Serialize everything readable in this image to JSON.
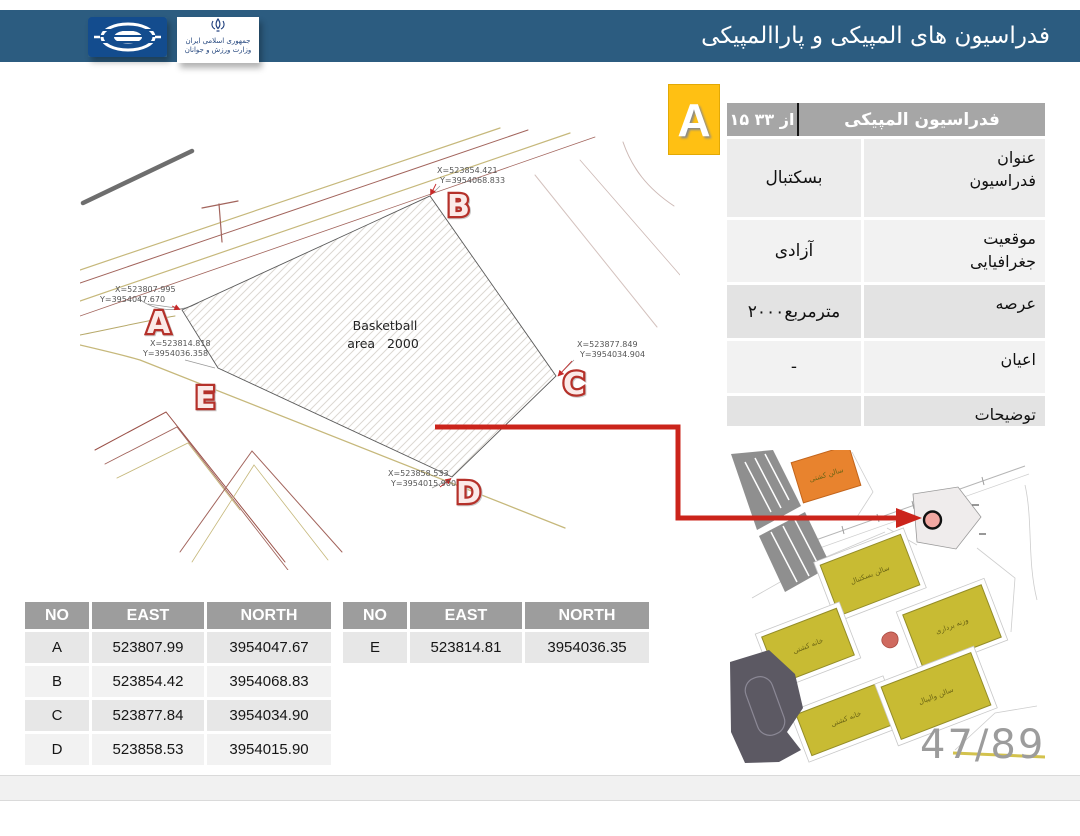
{
  "header": {
    "title": "فدراسیون های المپیکی و پاراالمپیکی",
    "ministry_line1": "جمهوری اسلامی ایران",
    "ministry_line2": "وزارت ورزش و جوانان"
  },
  "badge": {
    "letter": "A"
  },
  "info_table": {
    "header_title": "فدراسیون المپیکی",
    "header_counter": "۱۵ از ۳۳",
    "rows": [
      {
        "label": "عنوان\nفدراسیون",
        "value": "بسکتبال"
      },
      {
        "label": "موقعیت\nجغرافیایی",
        "value": "آزادی"
      },
      {
        "label": "عرصه",
        "value": "۲۰۰۰مترمربع"
      },
      {
        "label": "اعیان",
        "value": "-"
      },
      {
        "label": "توضیحات",
        "value": ""
      }
    ]
  },
  "drawing": {
    "area_label_line1": "Basketball",
    "area_label_line2": "area   2000",
    "points": [
      {
        "id": "A",
        "x_label": "X=523807.995",
        "y_label": "Y=3954047.670"
      },
      {
        "id": "B",
        "x_label": "X=523854.421",
        "y_label": "Y=3954068.833"
      },
      {
        "id": "C",
        "x_label": "X=523877.849",
        "y_label": "Y=3954034.904"
      },
      {
        "id": "D",
        "x_label": "X=523858.533",
        "y_label": "Y=3954015.900"
      },
      {
        "id": "E",
        "x_label": "X=523814.818",
        "y_label": "Y=3954036.358"
      }
    ]
  },
  "coord_tables": {
    "headers": [
      "NO",
      "EAST",
      "NORTH"
    ],
    "table1_rows": [
      [
        "A",
        "523807.99",
        "3954047.67"
      ],
      [
        "B",
        "523854.42",
        "3954068.83"
      ],
      [
        "C",
        "523877.84",
        "3954034.90"
      ],
      [
        "D",
        "523858.53",
        "3954015.90"
      ]
    ],
    "table2_rows": [
      [
        "E",
        "523814.81",
        "3954036.35"
      ]
    ]
  },
  "site_map": {
    "building_labels": [
      "سالن کشتی",
      "سالن بسکتبال",
      "وزنه برداری",
      "خانه کشتی",
      "خانه کشتی",
      "سالن والیبال"
    ]
  },
  "page_number": "47/89",
  "colors": {
    "header_blue": "#2C5C80",
    "badge_yellow": "#FFC013",
    "arrow_red": "#CB241B",
    "building_yellow": "#C8BB33",
    "building_orange": "#E8832E",
    "marker_pink": "#F2A8A2",
    "table_header_gray": "#9D9D9D"
  }
}
